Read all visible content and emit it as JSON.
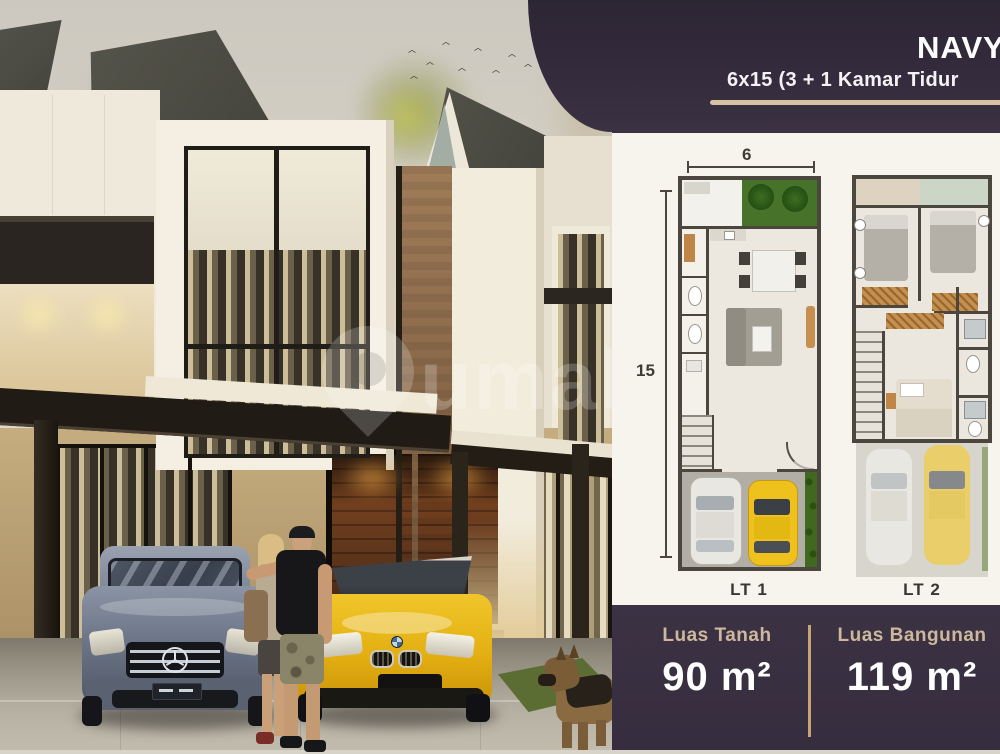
{
  "panel": {
    "title": "NAVY",
    "subtitle": "6x15 (3 + 1 Kamar Tidur",
    "colors": {
      "bg": "#3a3142",
      "accent": "#d8c2a3",
      "card": "#f7f4ee"
    },
    "floorplans": {
      "width_label": "6",
      "depth_label": "15",
      "lt1_label": "LT 1",
      "lt2_label": "LT 2"
    },
    "specs": [
      {
        "label": "Luas Tanah",
        "value": "90 m²"
      },
      {
        "label": "Luas Bangunan",
        "value": "119 m²"
      }
    ]
  },
  "scene": {
    "watermark_text": "umah",
    "colors": {
      "mercedes": "#76808f",
      "bmw": "#e9bb1a",
      "roof": "#49483f",
      "wall": "#f2ecdf"
    }
  }
}
